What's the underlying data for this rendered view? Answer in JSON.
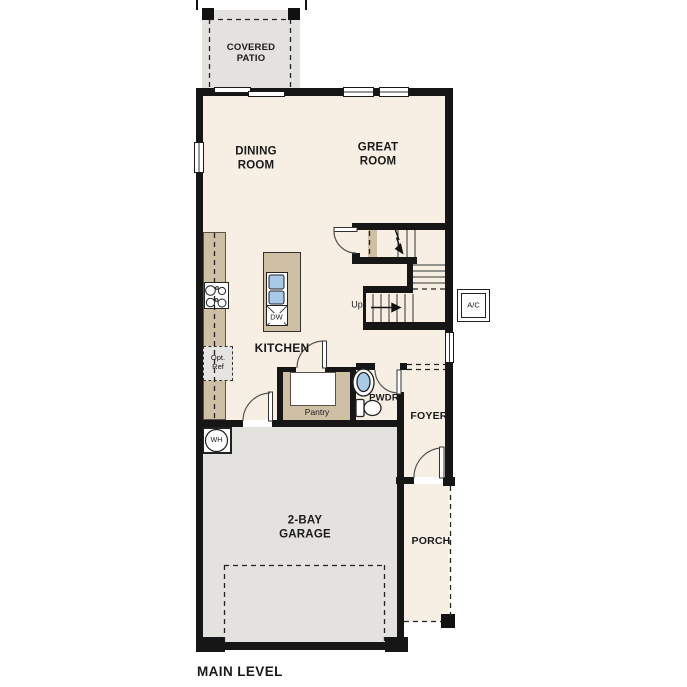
{
  "plan": {
    "title": "MAIN LEVEL",
    "rooms": {
      "covered_patio": "COVERED PATIO",
      "dining_room": "DINING ROOM",
      "great_room": "GREAT ROOM",
      "kitchen": "KITCHEN",
      "pantry": "Pantry",
      "powder_room": "PWDR",
      "foyer": "FOYER",
      "porch": "PORCH",
      "garage": "2-BAY GARAGE"
    },
    "annotations": {
      "stairs_direction": "Up",
      "optional_refrigerator": "Opt. Ref",
      "water_heater": "WH",
      "dishwasher": "DW",
      "air_conditioner": "A/C"
    },
    "colors": {
      "wall": "#161616",
      "interior_floor": "#f7efe3",
      "garage_patio_floor": "#e4e2df",
      "cabinetry": "#cfc0a5",
      "water_fixture": "#a9c9e9",
      "background": "#ffffff"
    }
  }
}
